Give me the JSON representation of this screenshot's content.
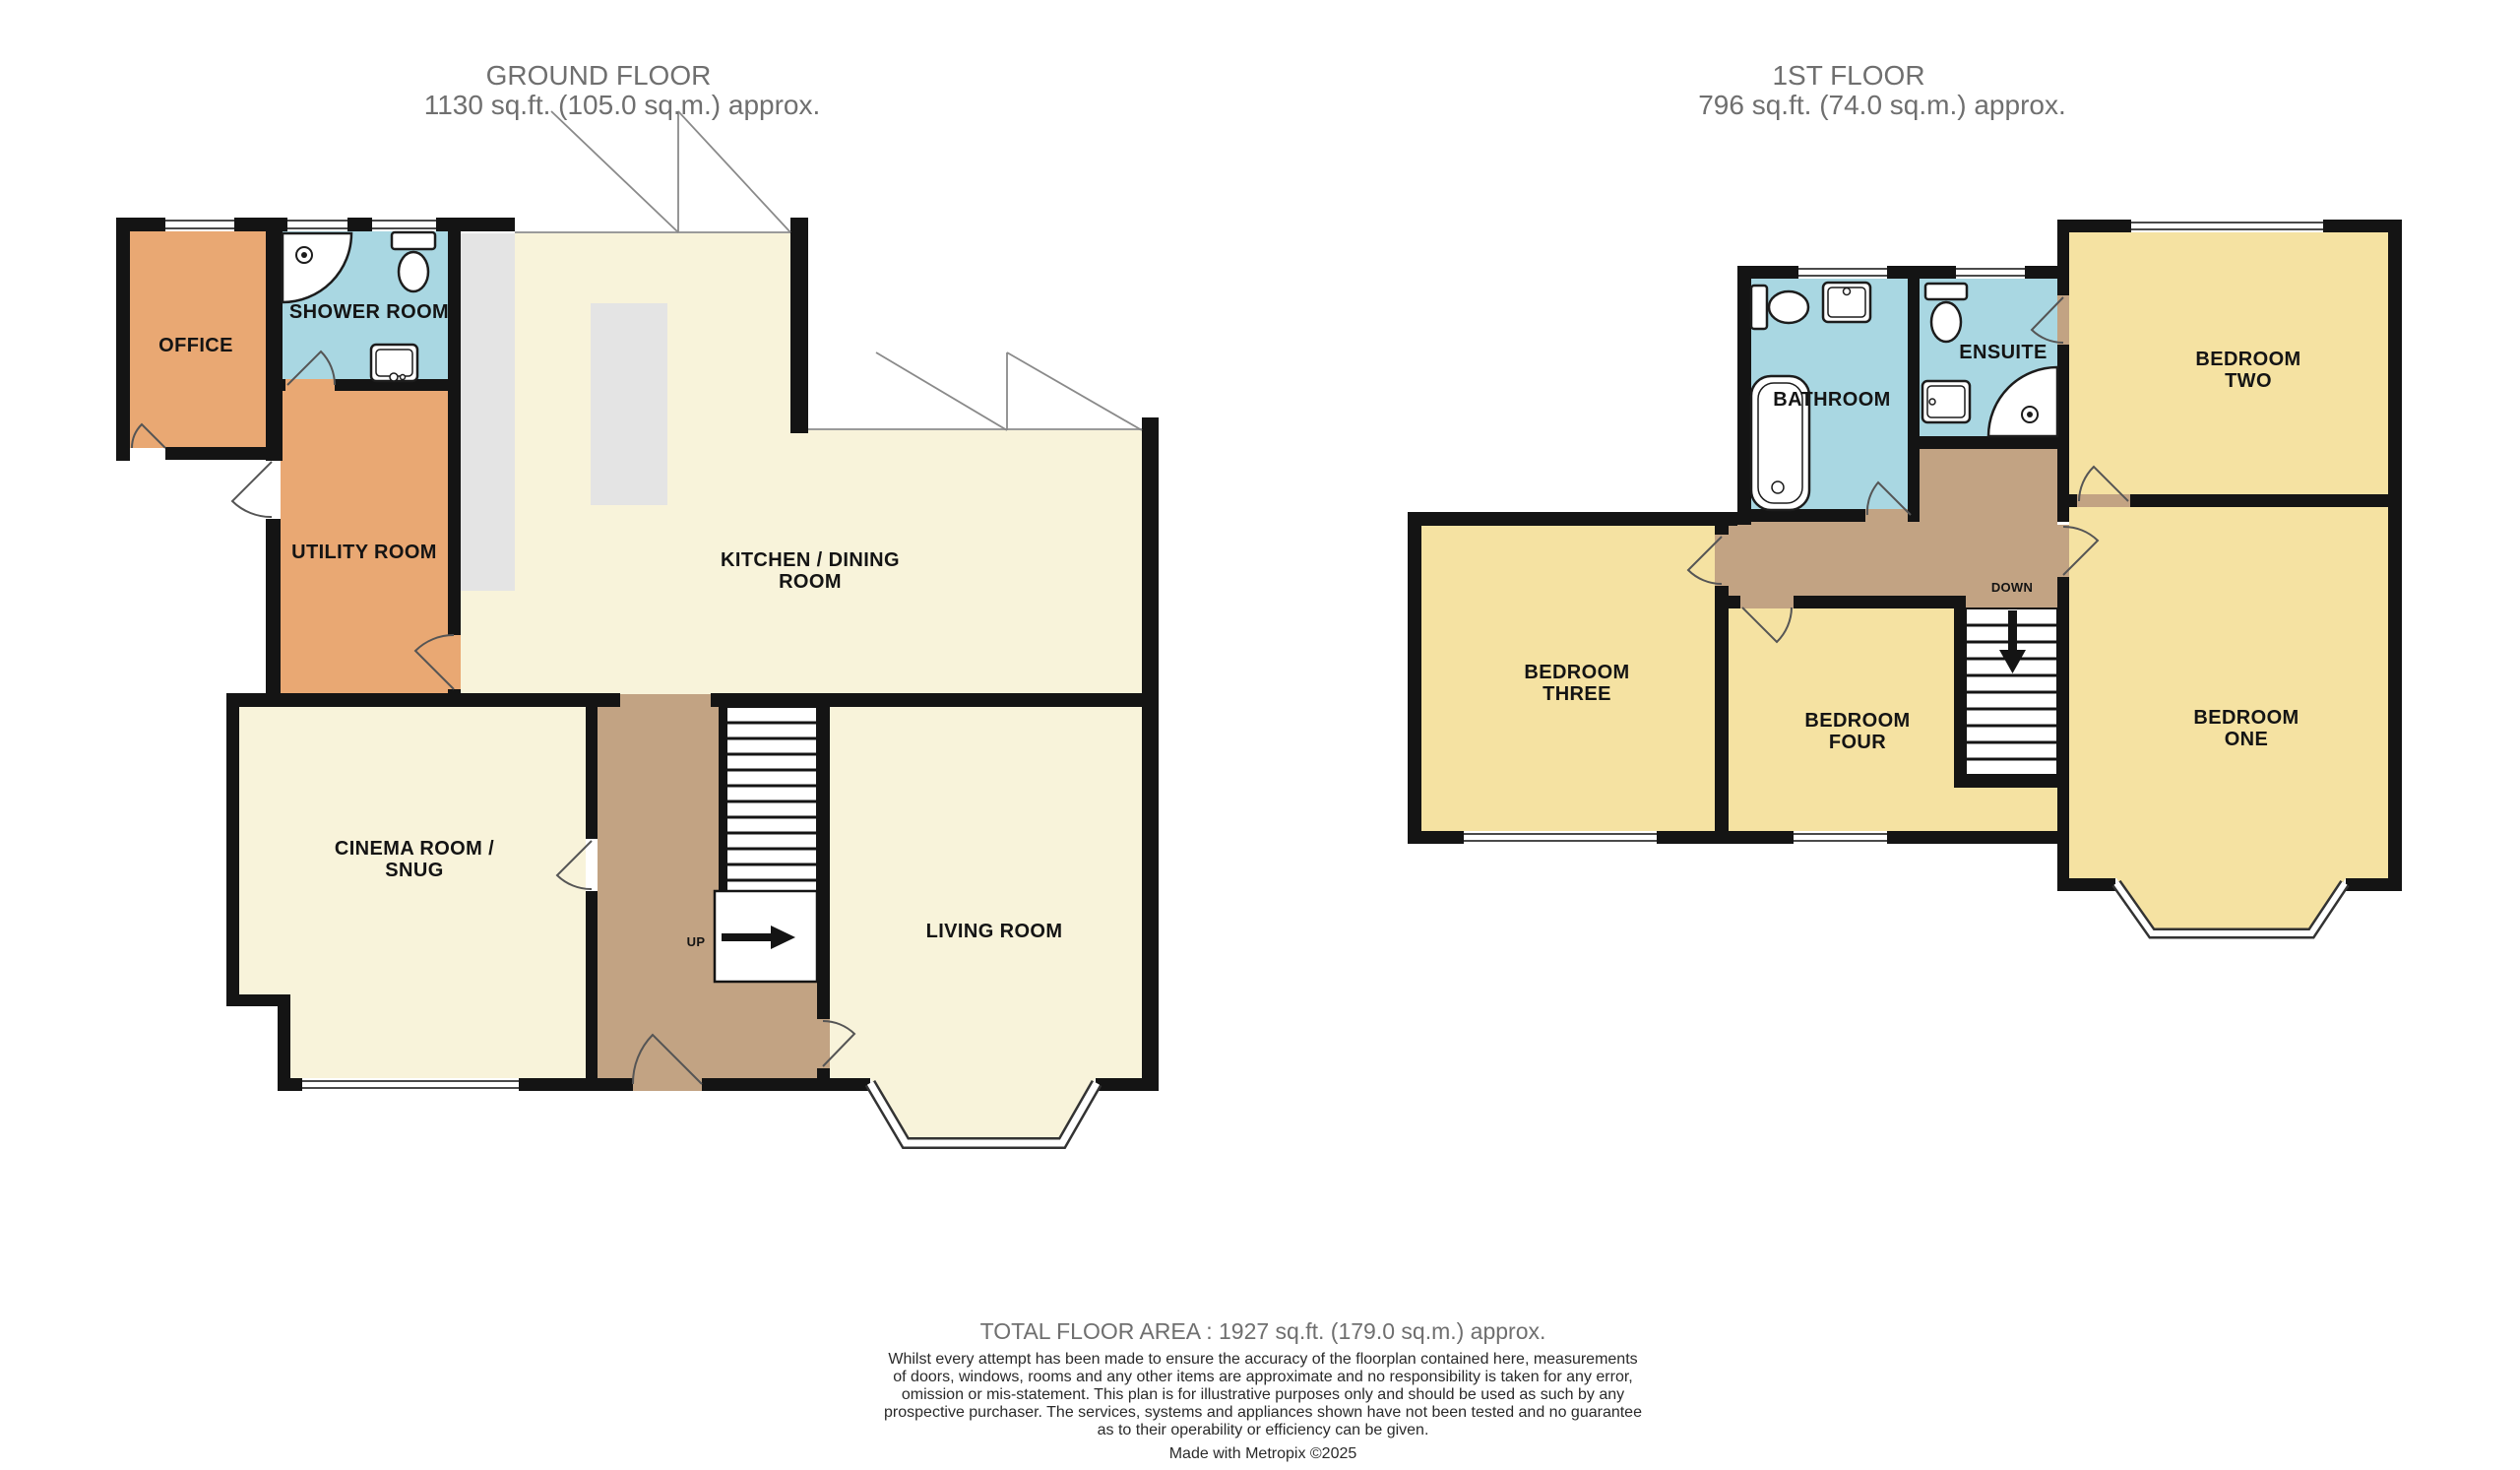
{
  "page": {
    "background": "#ffffff"
  },
  "colors": {
    "wall": "#141414",
    "floor_cream": "#f8f3da",
    "floor_orange": "#e9a873",
    "floor_blue": "#a9d7e2",
    "floor_gold": "#f5e2a2",
    "floor_tan": "#c2a383",
    "counter_grey": "#e4e4e4",
    "stair_white": "#ffffff",
    "window_line": "#4a4a4a",
    "glazing_line": "#9a9a9a",
    "heading_text": "#6f6f6f",
    "label_text": "#141414",
    "disclaimer_text": "#2a2a2a"
  },
  "ground_floor": {
    "title": "GROUND FLOOR",
    "area": "1130 sq.ft. (105.0 sq.m.) approx.",
    "rooms": {
      "office": "OFFICE",
      "shower_room": "SHOWER ROOM",
      "utility_room": "UTILITY ROOM",
      "kitchen_dining_line1": "KITCHEN / DINING",
      "kitchen_dining_line2": "ROOM",
      "cinema_snug_line1": "CINEMA ROOM /",
      "cinema_snug_line2": "SNUG",
      "living_room": "LIVING ROOM"
    },
    "stairs_label": "UP"
  },
  "first_floor": {
    "title": "1ST FLOOR",
    "area": "796 sq.ft. (74.0 sq.m.) approx.",
    "rooms": {
      "bathroom": "BATHROOM",
      "ensuite": "ENSUITE",
      "bedroom_one_line1": "BEDROOM",
      "bedroom_one_line2": "ONE",
      "bedroom_two_line1": "BEDROOM",
      "bedroom_two_line2": "TWO",
      "bedroom_three_line1": "BEDROOM",
      "bedroom_three_line2": "THREE",
      "bedroom_four_line1": "BEDROOM",
      "bedroom_four_line2": "FOUR"
    },
    "stairs_label": "DOWN"
  },
  "footer": {
    "total_area": "TOTAL FLOOR AREA : 1927 sq.ft. (179.0 sq.m.) approx.",
    "disclaimer_lines": [
      "Whilst every attempt has been made to ensure the accuracy of the floorplan contained here, measurements",
      "of doors, windows, rooms and any other items are approximate and no responsibility is taken for any error,",
      "omission or mis-statement. This plan is for illustrative purposes only and should be used as such by any",
      "prospective purchaser. The services, systems and appliances shown have not been tested and no guarantee",
      "as to their operability or efficiency can be given."
    ],
    "credit": "Made with Metropix ©2025"
  }
}
